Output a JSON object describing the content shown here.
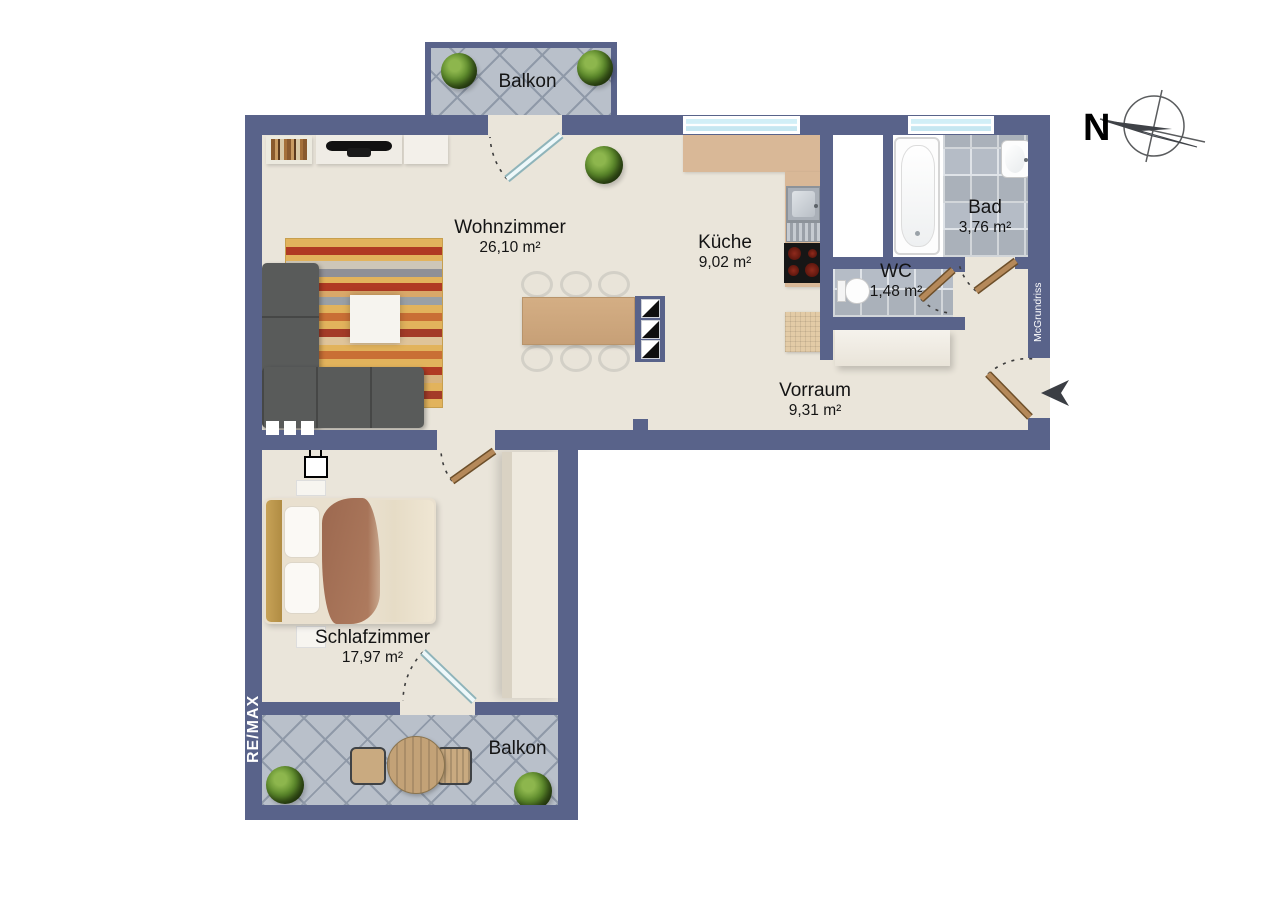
{
  "branding": {
    "agency_watermark": "RE/MAX",
    "generator_watermark": "McGrundriss"
  },
  "compass": {
    "north_label": "N"
  },
  "rooms": {
    "balkon_top": {
      "name": "Balkon"
    },
    "wohnzimmer": {
      "name": "Wohnzimmer",
      "area": "26,10 m²"
    },
    "kueche": {
      "name": "Küche",
      "area": "9,02 m²"
    },
    "bad": {
      "name": "Bad",
      "area": "3,76 m²"
    },
    "wc": {
      "name": "WC",
      "area": "1,48 m²"
    },
    "vorraum": {
      "name": "Vorraum",
      "area": "9,31 m²"
    },
    "schlafzimmer": {
      "name": "Schlafzimmer",
      "area": "17,97 m²"
    },
    "balkon_bottom": {
      "name": "Balkon"
    }
  },
  "colors": {
    "wall": "#59638a",
    "floor": "#eae5da",
    "balcony_tile": "#b9c0ca",
    "bath_tile": "#b5bcc6",
    "kitchen_counter": "#d9b897",
    "door_wood": "#b2885a",
    "glass_door": "#e8f6f8"
  }
}
